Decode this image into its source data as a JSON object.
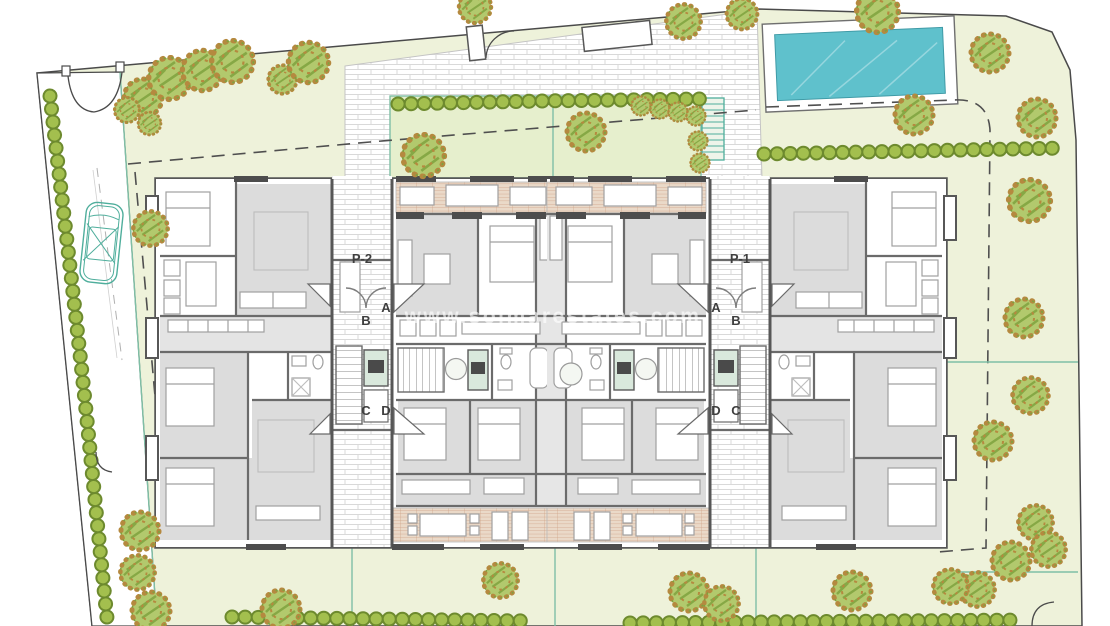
{
  "page": {
    "title": "Residential complex ground floor site plan"
  },
  "watermark": {
    "text": "www.solmarestates.com"
  },
  "labels": {
    "block_left": "P-2",
    "block_right": "P-1",
    "entrance_a": "A",
    "entrance_b": "B",
    "entrance_c": "C",
    "entrance_d": "D"
  },
  "colors": {
    "background": "#ffffff",
    "site_green": "#eef2da",
    "courtyard_green": "#e6efcd",
    "pool_water": "#5fc1cc",
    "tree_green": "#b2c96d",
    "tree_hatch": "#86a845",
    "tree_ring": "#b5893f",
    "hedge_green": "#a3bf4e",
    "hedge_outline": "#6d8a2e",
    "wall_grey": "#575757",
    "room_grey": "#dcdcdc",
    "terrace_tan": "#ead9c8",
    "accent_teal": "#6fb9a4",
    "boundary_grey": "#4a4a4a",
    "watermark_white": "rgba(255,255,255,0.62)"
  }
}
